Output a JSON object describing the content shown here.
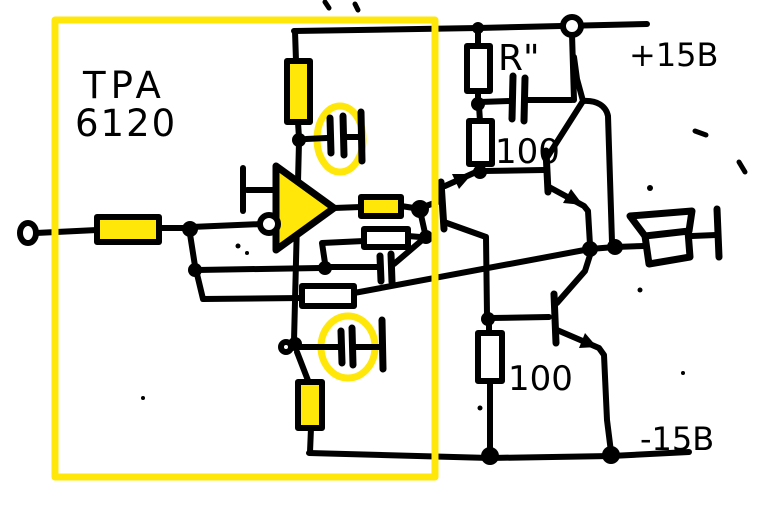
{
  "schematic": {
    "type": "hand-drawn-circuit-diagram",
    "chip": {
      "label_line1": "TPA",
      "label_line2": "6120"
    },
    "labels": {
      "series_resistor_top": "R\"",
      "emitter_resistor_upper": "100",
      "emitter_resistor_lower": "100",
      "supply_positive": "+15B",
      "supply_negative": "-15B"
    },
    "colors": {
      "highlight": "#FFE70A",
      "ink": "#000000",
      "paper": "#FFFFFF"
    },
    "components": {
      "opamp": "tpa6120-opamp",
      "highlight_box": "yellow-highlight-box",
      "bypass_caps": "circled-bypass-capacitors",
      "output_stage": "transistor-buffer-stage",
      "load": "loudspeaker"
    }
  }
}
